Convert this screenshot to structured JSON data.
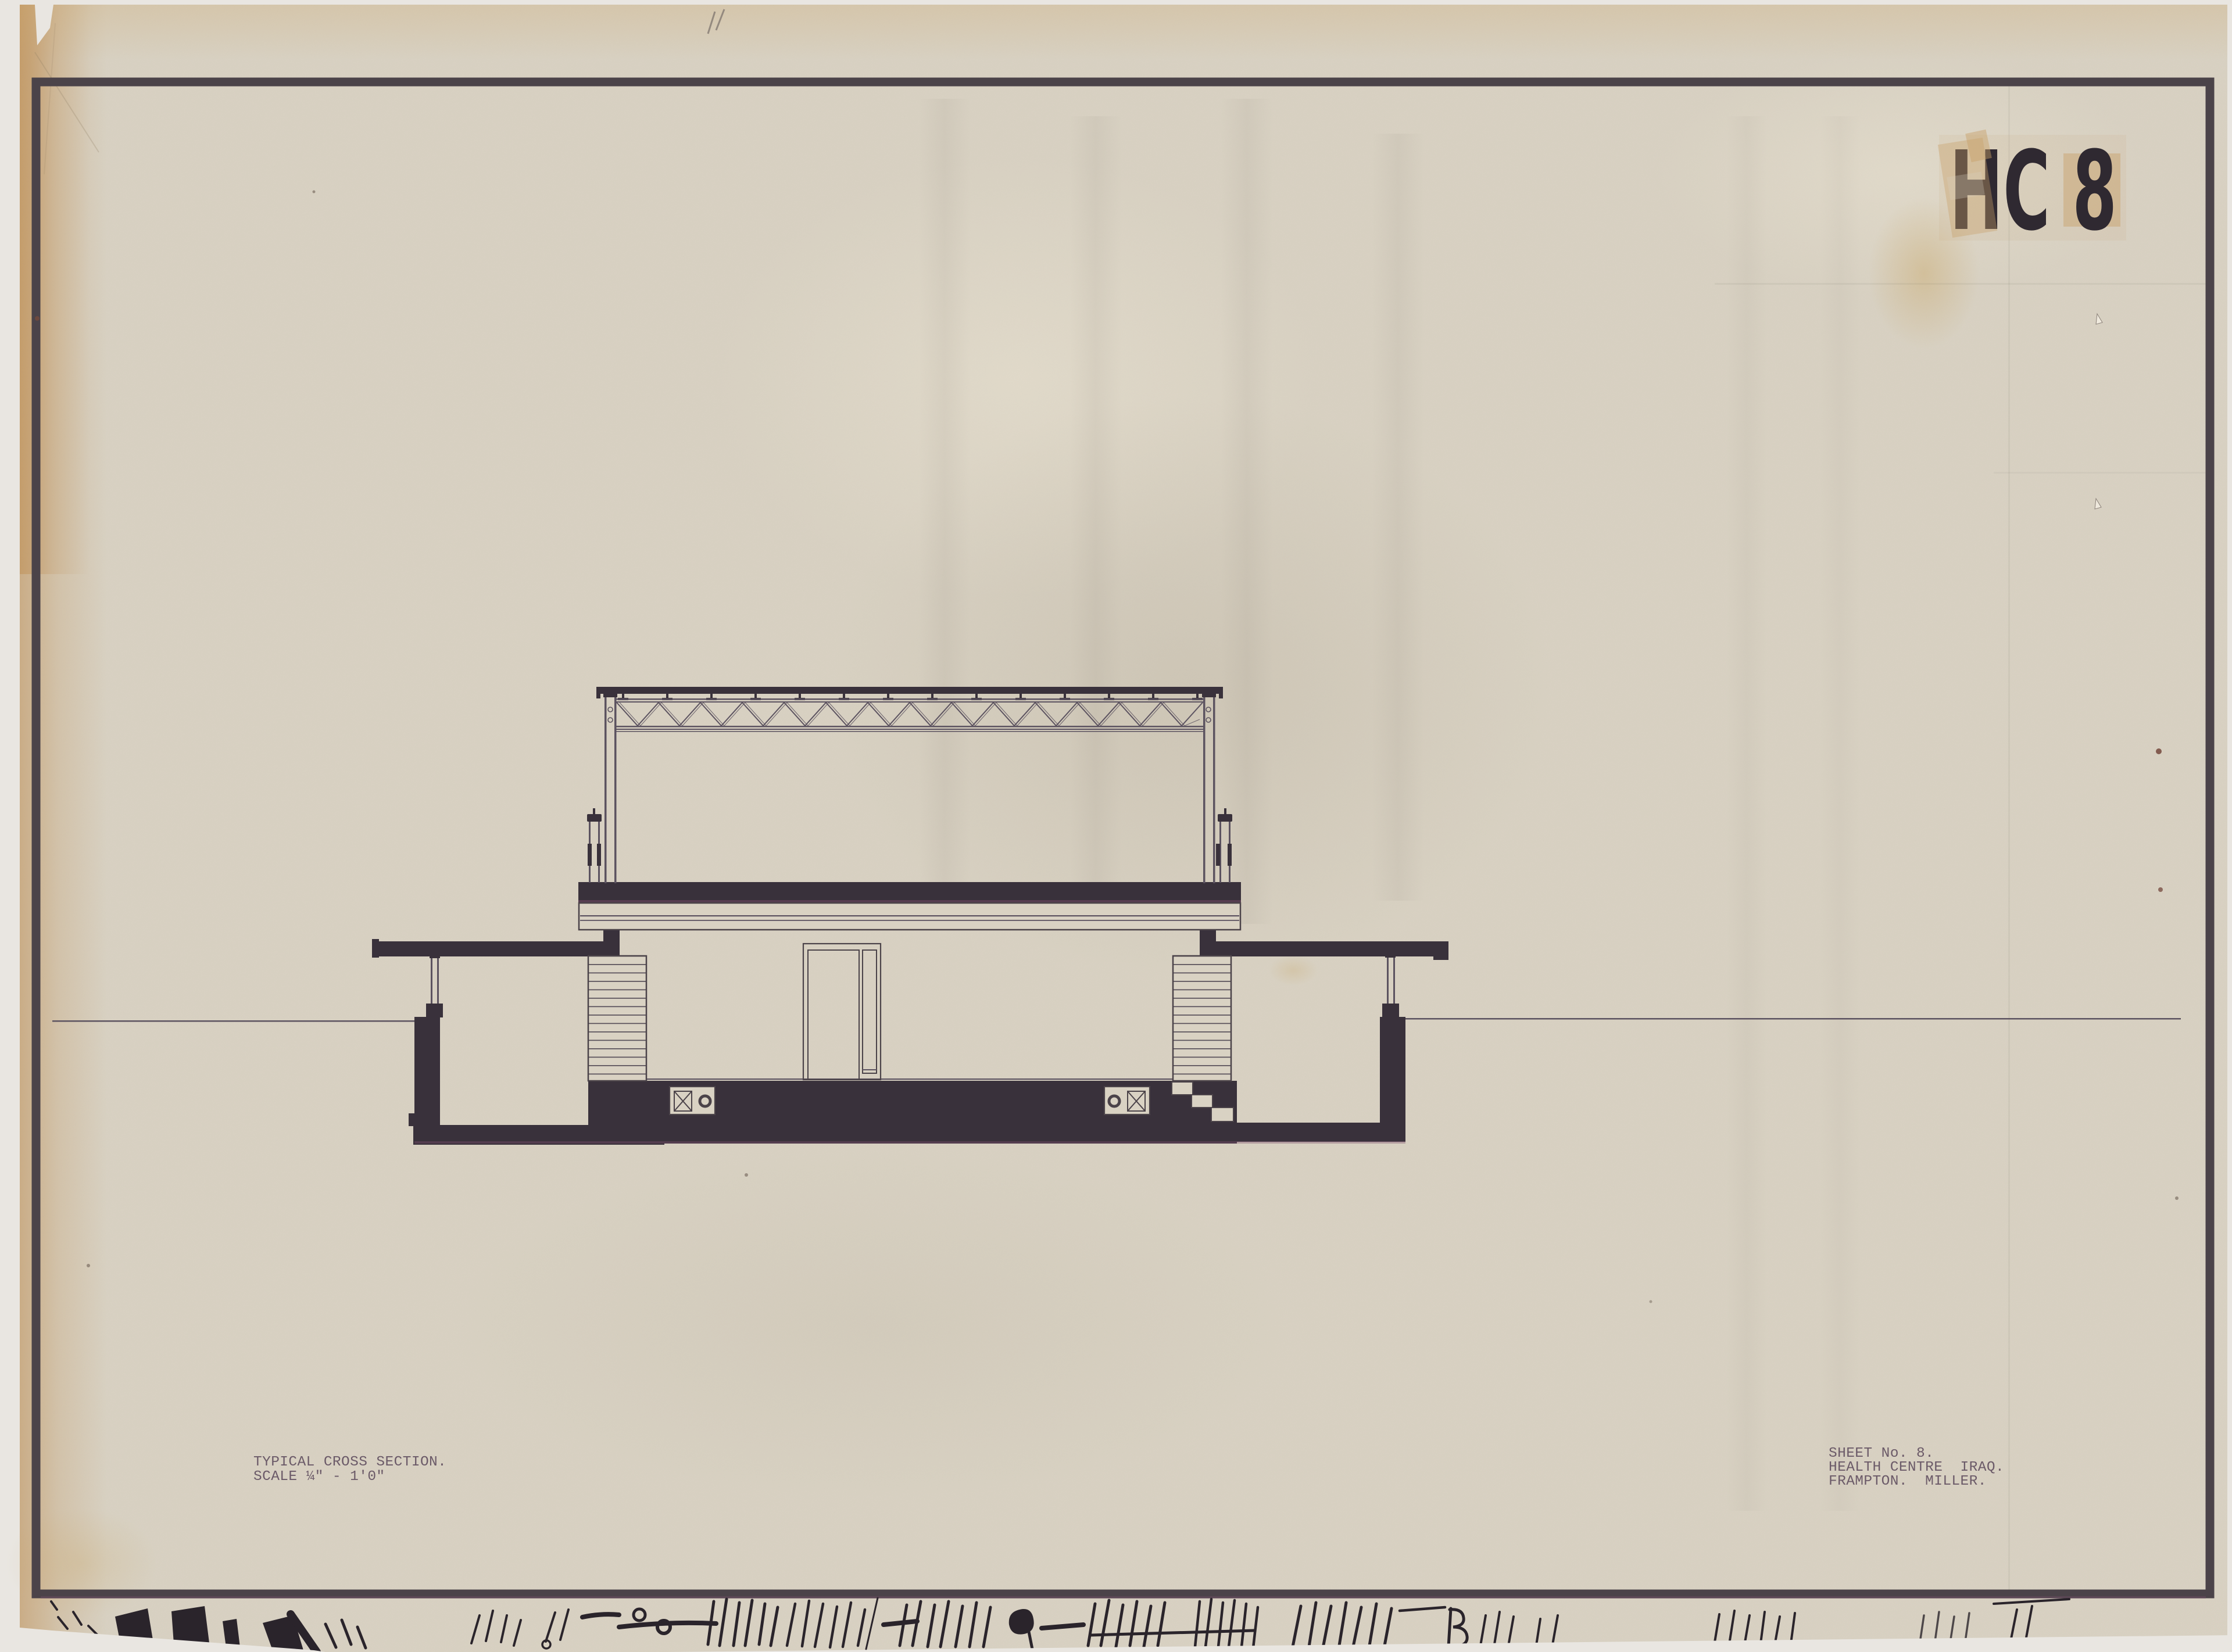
{
  "document": {
    "stamp": {
      "code": "HC 8"
    },
    "title_block": {
      "line1": "TYPICAL CROSS SECTION.",
      "line2": "SCALE ¼\" - 1'0\""
    },
    "info_block": {
      "line1": "SHEET No. 8.",
      "line2": "HEALTH CENTRE  IRAQ.",
      "line3": "FRAMPTON.  MILLER."
    },
    "colors": {
      "background": "#e9e6e1",
      "paper": "#d9d2c3",
      "frame": "#4b4349",
      "ink": "#39313b",
      "line": "#5c5360",
      "hatch": "#564e58",
      "type": "#6b5a68",
      "stamp_ink": "#2f2931",
      "tape": "#c8a069",
      "fringe": "#7c4f6d",
      "pencil": "#2a242b"
    }
  }
}
